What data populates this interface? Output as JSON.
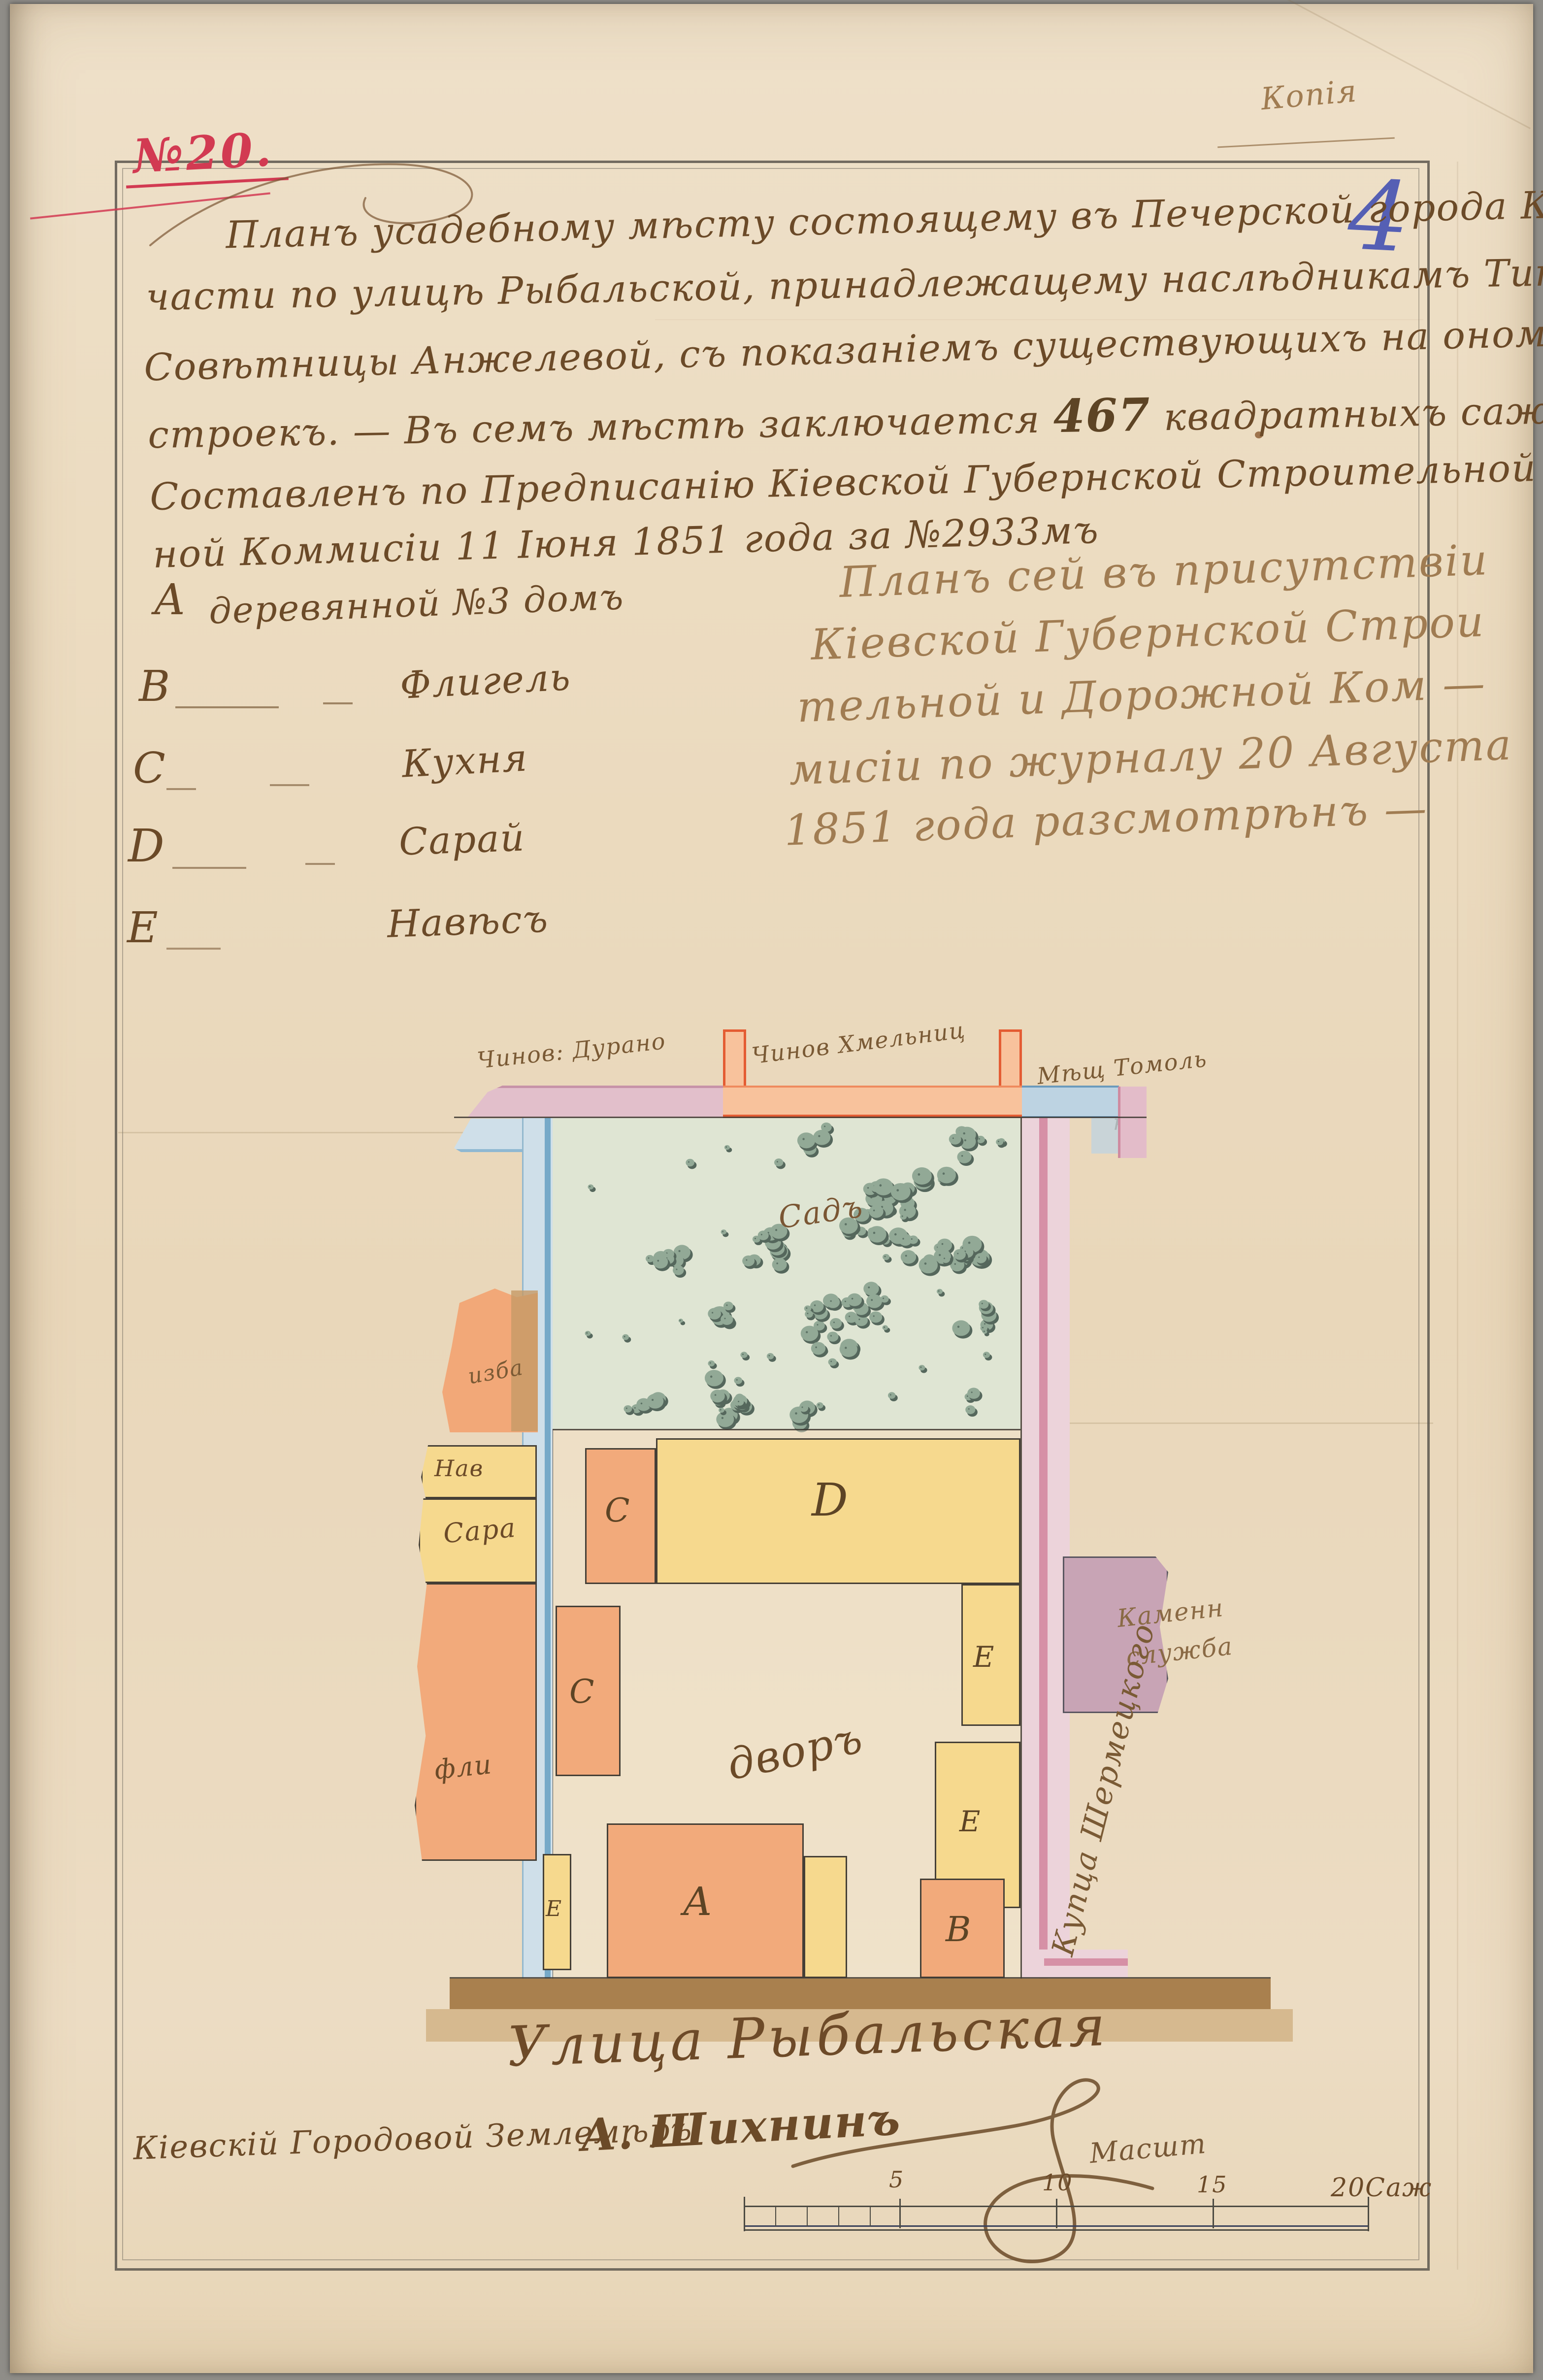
{
  "document": {
    "copy_note": "Копія",
    "sheet_number": "4",
    "case_number": "№20.",
    "title": {
      "l1": "Планъ усадебному мѣсту состоящему въ Печерской города Кіева",
      "l2": "части по улицѣ Рыбальской, принадлежащему наслѣдникамъ Титул.",
      "l3": "Совѣтницы Анжелевой, съ показаніемъ существующихъ на ономъ по-",
      "l4a": "строекъ. — Въ семъ мѣстѣ заключается ",
      "l4num": "467",
      "l4b": " квадратныхъ саженъ. —",
      "l5": "Составленъ по Предписанію Кіевской Губернской Строительной и Дорож-",
      "l6": "ной Коммисіи 11 Іюня 1851 года за №2933мъ"
    },
    "legend": {
      "items": [
        {
          "letter": "А",
          "label": "деревянной №3 домъ"
        },
        {
          "letter": "В",
          "label": "Флигель"
        },
        {
          "letter": "С",
          "label": "Кухня"
        },
        {
          "letter": "D",
          "label": "Сарай"
        },
        {
          "letter": "Е",
          "label": "Навѣсъ"
        }
      ]
    },
    "approval": {
      "l1": "Планъ сей въ присутствіи",
      "l2": "Кіевской Губернской Строи",
      "l3": "тельной и Дорожной Ком —",
      "l4": "мисіи по журналу 20 Августа",
      "l5": "1851 года разсмотрѣнъ —"
    }
  },
  "plan": {
    "neighbor_top_left_1": "Чинов: Дурано",
    "neighbor_top_left_2": "ва",
    "neighbor_top_mid_1": "Чинов Хмельниц",
    "neighbor_top_mid_2": "кого",
    "neighbor_top_right_1": "Мѣщ Томоль",
    "neighbor_top_right_2": "ка",
    "garden": "Садъ",
    "courtyard": "дворъ",
    "labels": {
      "a": "А",
      "b": "В",
      "c": "С",
      "d": "D",
      "e": "Е"
    },
    "fragments": {
      "f1": "изба",
      "f2": "Нав",
      "f3": "Сара",
      "f4": "фли"
    },
    "stone_service_1": "Каменн",
    "stone_service_2": "служба",
    "side_street": "Купца Шермецкого",
    "street": "Улица Рыбальская"
  },
  "footer": {
    "surveyor_title": "Кіевскій Городовой Землемѣръ",
    "surveyor_name": "А. Шихнинъ",
    "scale_caption": "Масшт",
    "scale_ticks": [
      "5",
      "10",
      "15",
      "20Саж"
    ]
  },
  "colors": {
    "paper": "#ead9bd",
    "ink_brown": "#6b4a28",
    "ink_faded": "#a07c52",
    "ink_red": "#d23a52",
    "ink_blue": "#5a60b8",
    "wash_orange": "#f2aa7b",
    "wash_yellow": "#f6d98e",
    "wash_green": "#e0e6d5",
    "bush_green": "#8fa795",
    "wash_blue": "#cfdfe9",
    "wash_rose": "#ecd2da",
    "wash_purple": "#c8a4b5",
    "street_brown": "#a9804e"
  }
}
